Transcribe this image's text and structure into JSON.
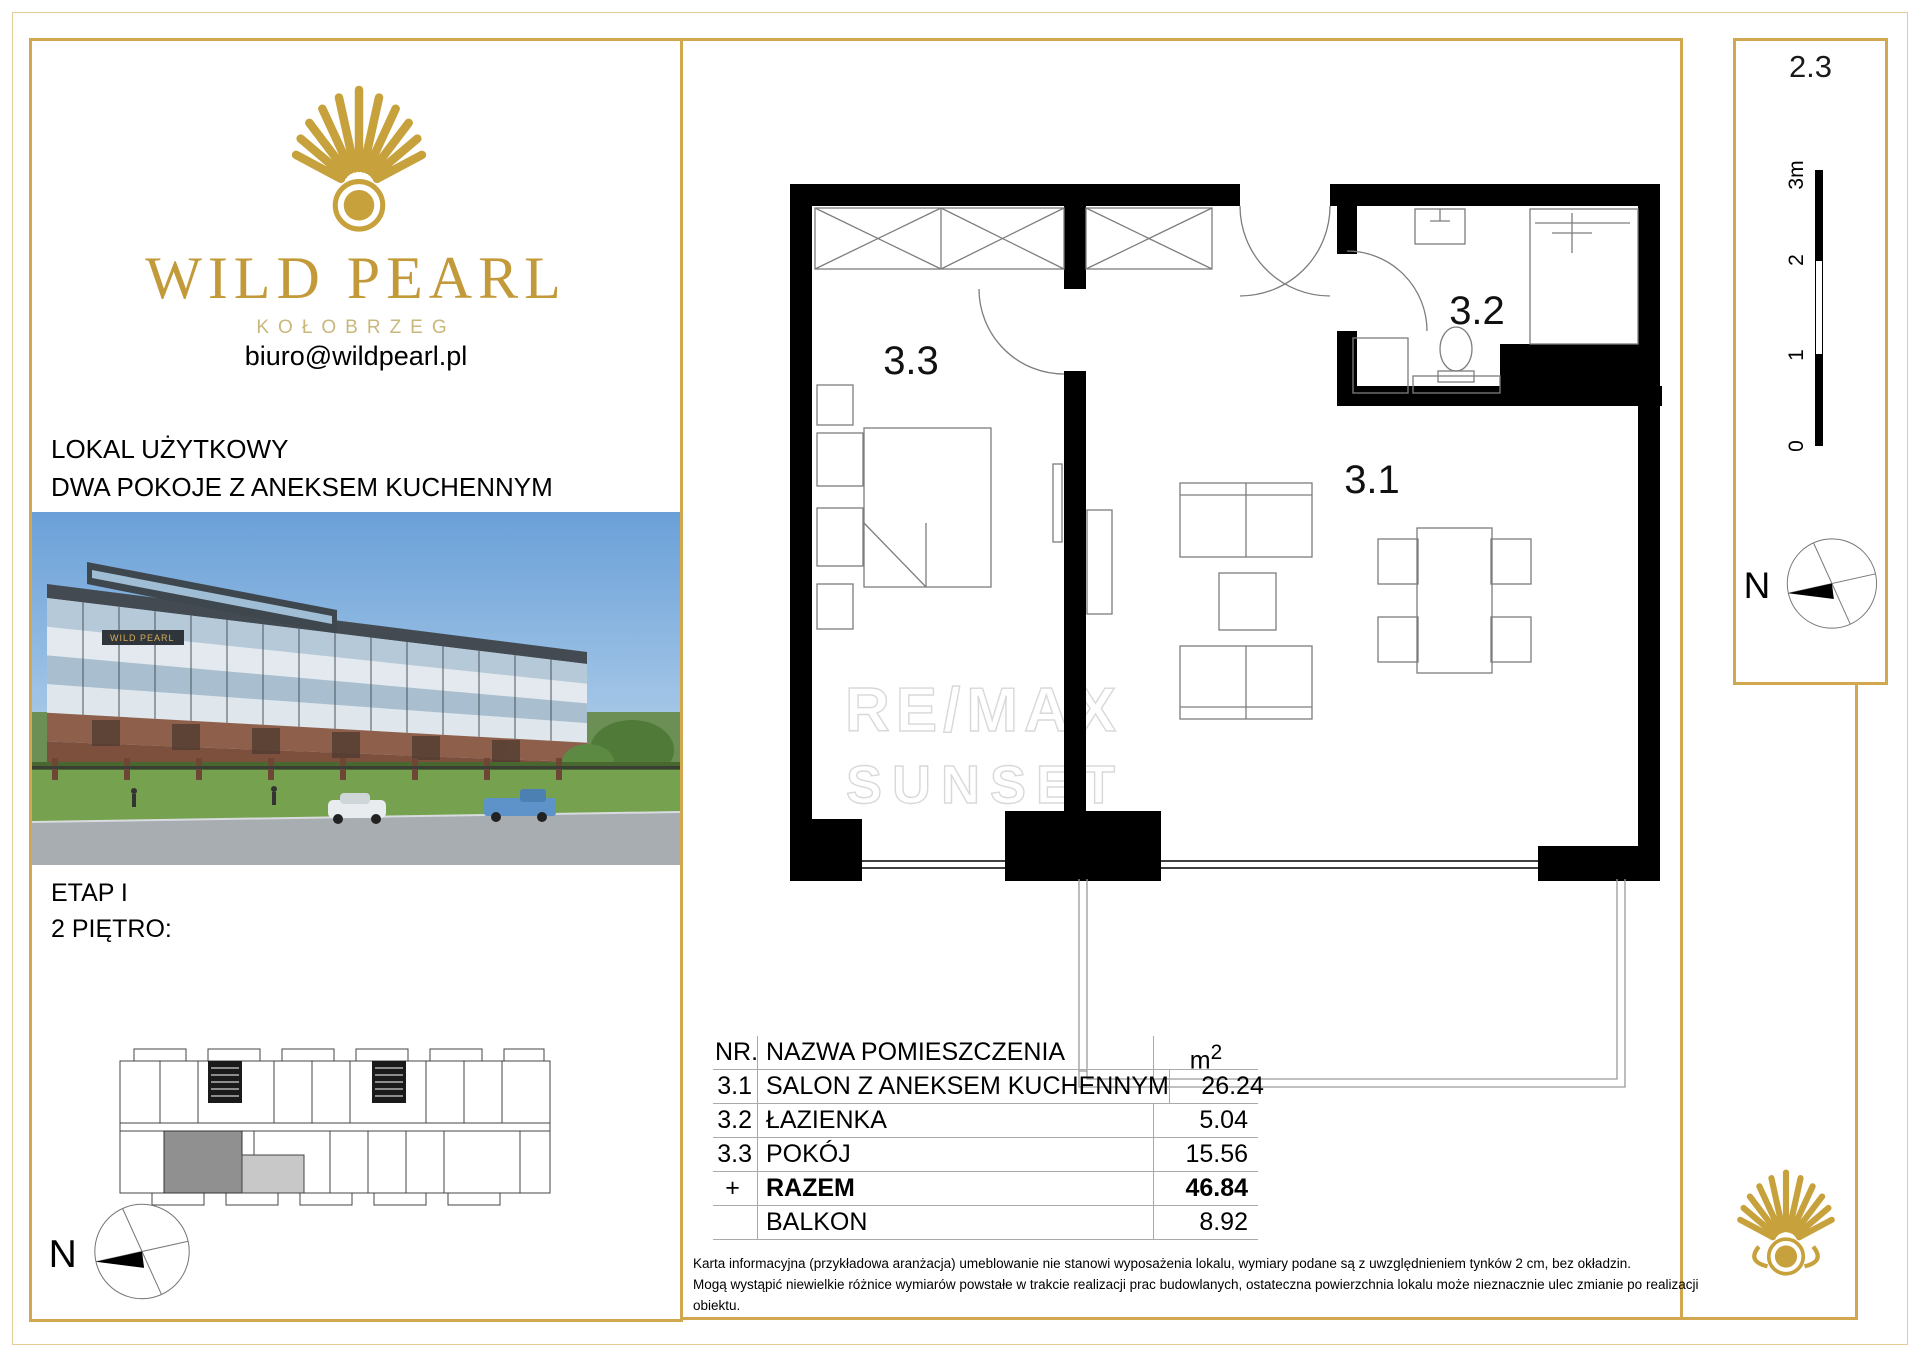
{
  "unit": {
    "number": "2.3"
  },
  "brand": {
    "name": "WILD PEARL",
    "city": "KOŁOBRZEG",
    "email": "biuro@wildpearl.pl"
  },
  "left": {
    "offer_line1": "LOKAL UŻYTKOWY",
    "offer_line2": "DWA POKOJE Z ANEKSEM KUCHENNYM",
    "stage": "ETAP I",
    "floor": "2 PIĘTRO:",
    "compass_n": "N"
  },
  "plan": {
    "room_31": "3.1",
    "room_32": "3.2",
    "room_33": "3.3",
    "watermark_line1": "RE/MAX",
    "watermark_line2": "SUNSET"
  },
  "scale_ruler": {
    "l3": "3m",
    "l2": "2",
    "l1": "1",
    "l0": "0"
  },
  "strip": {
    "compass_n": "N"
  },
  "table": {
    "header": {
      "nr": "NR.",
      "name": "NAZWA POMIESZCZENIA",
      "area_base": "m",
      "area_sup": "2"
    },
    "rows": [
      {
        "nr": "3.1",
        "name": "SALON Z ANEKSEM KUCHENNYM",
        "area": "26.24",
        "bold": false
      },
      {
        "nr": "3.2",
        "name": "ŁAZIENKA",
        "area": "5.04",
        "bold": false
      },
      {
        "nr": "3.3",
        "name": "POKÓJ",
        "area": "15.56",
        "bold": false
      },
      {
        "nr": "+",
        "name": "RAZEM",
        "area": "46.84",
        "bold": true
      },
      {
        "nr": "",
        "name": "BALKON",
        "area": "8.92",
        "bold": false
      }
    ],
    "disclaimer_line1": "Karta informacyjna (przykładowa aranżacja) umeblowanie nie stanowi wyposażenia lokalu, wymiary podane są z uwzględnieniem tynków 2 cm, bez okładzin.",
    "disclaimer_line2": "Mogą wystąpić niewielkie różnice wymiarów powstałe w trakcie realizacji prac budowlanych, ostateczna powierzchnia lokalu może nieznacznie ulec zmianie po realizacji obiektu."
  },
  "colors": {
    "gold_border": "#d1a750",
    "gold_brand": "#c29a3a",
    "gold_light": "#c9b77c",
    "hairline": "#aaaaaa",
    "watermark": "#b3b3b3",
    "highlight_unit_gray": "#909090"
  }
}
